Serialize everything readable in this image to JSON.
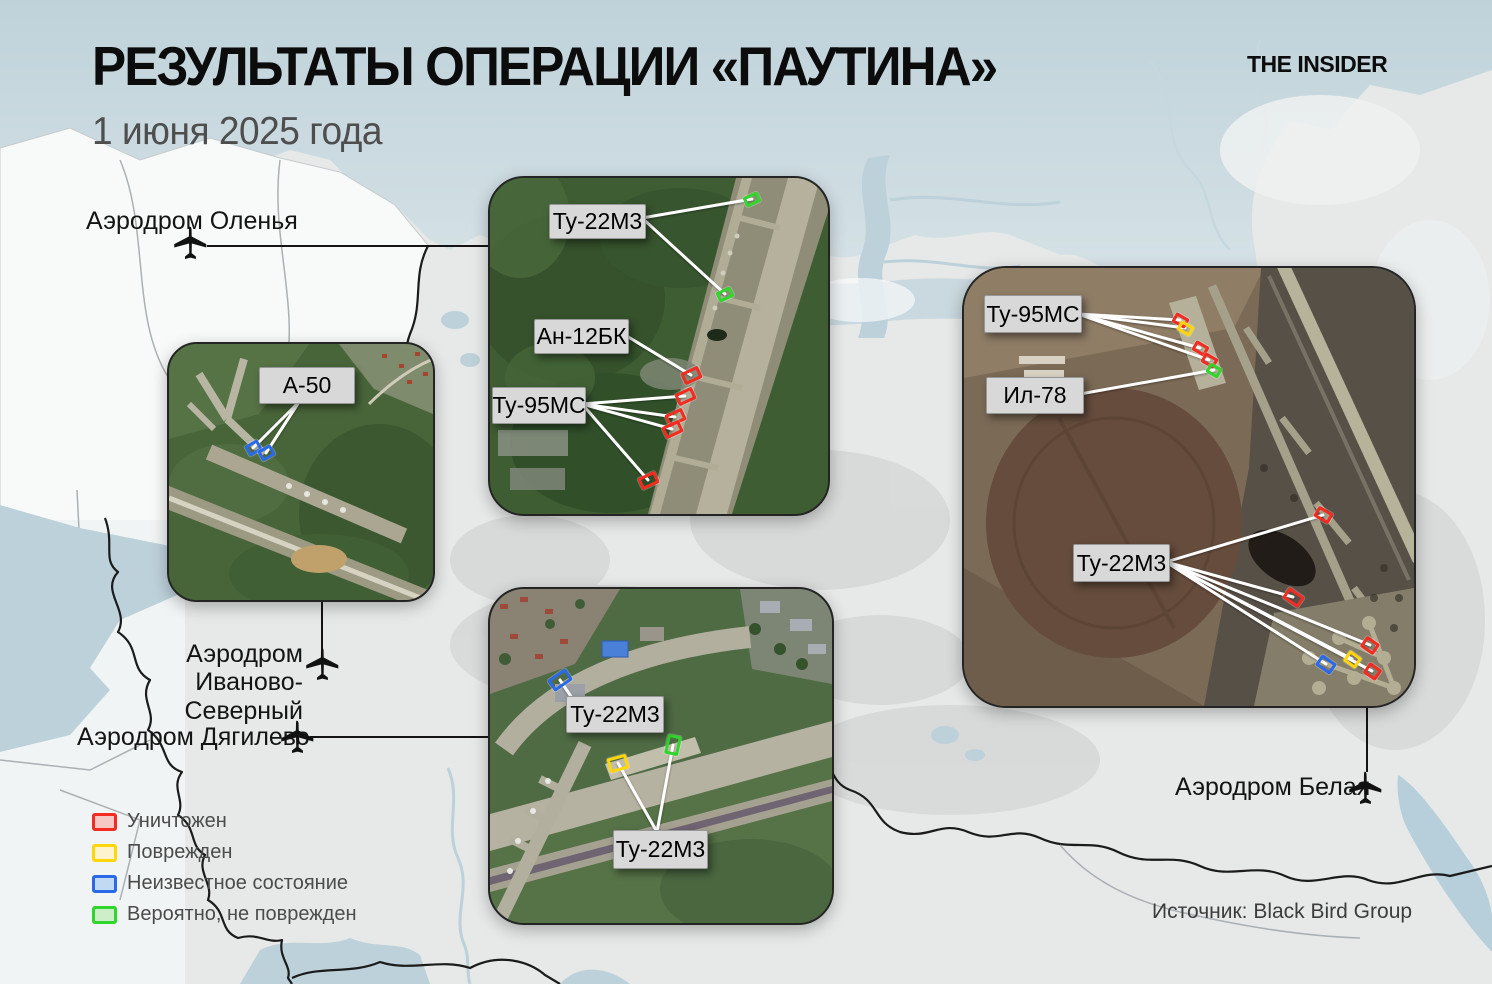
{
  "header": {
    "title": "РЕЗУЛЬТАТЫ ОПЕРАЦИИ «ПАУТИНА»",
    "subtitle": "1 июня 2025 года",
    "logo": "THE INSIDER"
  },
  "source_note": "Источник: Black Bird Group",
  "status_colors": {
    "destroyed": {
      "border": "#f32b20",
      "fill": "#f6c9c6"
    },
    "damaged": {
      "border": "#ffd60a",
      "fill": "#fdf3cc"
    },
    "unknown": {
      "border": "#2a6ae8",
      "fill": "#c2d9f4"
    },
    "undamaged": {
      "border": "#2fd62b",
      "fill": "#cdeec9"
    }
  },
  "legend": {
    "items": [
      {
        "label": "Уничтожен",
        "status": "destroyed"
      },
      {
        "label": "Поврежден",
        "status": "damaged"
      },
      {
        "label": "Неизвестное состояние",
        "status": "unknown"
      },
      {
        "label": "Вероятно, не поврежден",
        "status": "undamaged"
      }
    ]
  },
  "airfields": [
    {
      "name": "Аэродром Оленья"
    },
    {
      "name": "Аэродром Иваново-Северный"
    },
    {
      "name": "Аэродром Дягилево"
    },
    {
      "name": "Аэродром Белая"
    }
  ],
  "insets": {
    "olenya": {
      "callouts": [
        {
          "text": "Ту-22М3",
          "box": {
            "x": 59,
            "y": 26,
            "w": 95,
            "h": 33
          },
          "anchor": {
            "x": 152,
            "y": 40
          },
          "targets": [
            0,
            1
          ]
        },
        {
          "text": "Ан-12БК",
          "box": {
            "x": 44,
            "y": 141,
            "w": 93,
            "h": 33
          },
          "anchor": {
            "x": 135,
            "y": 157
          },
          "targets": [
            2
          ]
        },
        {
          "text": "Ту-95МС",
          "box": {
            "x": 2,
            "y": 209,
            "w": 92,
            "h": 35
          },
          "anchor": {
            "x": 92,
            "y": 226
          },
          "targets": [
            3,
            4,
            5,
            6
          ]
        }
      ],
      "markers": [
        {
          "x": 262,
          "y": 21,
          "w": 16,
          "h": 11,
          "rot": -25,
          "status": "undamaged"
        },
        {
          "x": 235,
          "y": 116,
          "w": 16,
          "h": 11,
          "rot": -25,
          "status": "undamaged"
        },
        {
          "x": 201,
          "y": 197,
          "w": 19,
          "h": 13,
          "rot": -25,
          "status": "destroyed"
        },
        {
          "x": 195,
          "y": 218,
          "w": 19,
          "h": 13,
          "rot": -25,
          "status": "destroyed"
        },
        {
          "x": 185,
          "y": 239,
          "w": 19,
          "h": 13,
          "rot": -25,
          "status": "destroyed"
        },
        {
          "x": 182,
          "y": 251,
          "w": 19,
          "h": 13,
          "rot": -25,
          "status": "destroyed"
        },
        {
          "x": 158,
          "y": 302,
          "w": 19,
          "h": 13,
          "rot": -25,
          "status": "destroyed"
        }
      ]
    },
    "ivanovo": {
      "callouts": [
        {
          "text": "А-50",
          "box": {
            "x": 90,
            "y": 23,
            "w": 94,
            "h": 35
          },
          "anchor": {
            "x": 130,
            "y": 58
          },
          "targets": [
            0,
            1
          ]
        }
      ],
      "markers": [
        {
          "x": 84,
          "y": 104,
          "w": 15,
          "h": 12,
          "rot": -30,
          "status": "unknown"
        },
        {
          "x": 97,
          "y": 109,
          "w": 15,
          "h": 12,
          "rot": -30,
          "status": "unknown"
        }
      ]
    },
    "dyagilevo": {
      "callouts": [
        {
          "text": "Ту-22М3",
          "box": {
            "x": 76,
            "y": 107,
            "w": 96,
            "h": 35
          },
          "anchor": {
            "x": 84,
            "y": 112
          },
          "targets": [
            0
          ]
        },
        {
          "text": "Ту-22М3",
          "box": {
            "x": 123,
            "y": 241,
            "w": 93,
            "h": 37
          },
          "anchor": {
            "x": 167,
            "y": 243
          },
          "targets": [
            1,
            2
          ]
        }
      ],
      "markers": [
        {
          "x": 70,
          "y": 91,
          "w": 22,
          "h": 14,
          "rot": -35,
          "status": "unknown"
        },
        {
          "x": 128,
          "y": 174,
          "w": 20,
          "h": 15,
          "rot": -15,
          "status": "damaged"
        },
        {
          "x": 183,
          "y": 156,
          "w": 14,
          "h": 20,
          "rot": 12,
          "status": "undamaged"
        }
      ]
    },
    "belaya": {
      "callouts": [
        {
          "text": "Ту-95МС",
          "box": {
            "x": 20,
            "y": 27,
            "w": 96,
            "h": 36
          },
          "anchor": {
            "x": 114,
            "y": 46
          },
          "targets": [
            0,
            1,
            2,
            3
          ]
        },
        {
          "text": "Ил-78",
          "box": {
            "x": 22,
            "y": 109,
            "w": 96,
            "h": 35
          },
          "anchor": {
            "x": 116,
            "y": 126
          },
          "targets": [
            4
          ]
        },
        {
          "text": "Ту-22М3",
          "box": {
            "x": 109,
            "y": 276,
            "w": 95,
            "h": 36
          },
          "anchor": {
            "x": 202,
            "y": 294
          },
          "targets": [
            5,
            6,
            7,
            8,
            9,
            10
          ]
        }
      ],
      "markers": [
        {
          "x": 216,
          "y": 52,
          "w": 15,
          "h": 11,
          "rot": 30,
          "status": "destroyed"
        },
        {
          "x": 221,
          "y": 60,
          "w": 15,
          "h": 11,
          "rot": 30,
          "status": "damaged"
        },
        {
          "x": 236,
          "y": 80,
          "w": 15,
          "h": 11,
          "rot": 30,
          "status": "destroyed"
        },
        {
          "x": 245,
          "y": 92,
          "w": 15,
          "h": 11,
          "rot": 30,
          "status": "destroyed"
        },
        {
          "x": 250,
          "y": 102,
          "w": 14,
          "h": 11,
          "rot": 30,
          "status": "undamaged"
        },
        {
          "x": 359,
          "y": 247,
          "w": 17,
          "h": 12,
          "rot": 30,
          "status": "destroyed"
        },
        {
          "x": 329,
          "y": 329,
          "w": 19,
          "h": 13,
          "rot": 35,
          "status": "destroyed"
        },
        {
          "x": 406,
          "y": 377,
          "w": 16,
          "h": 13,
          "rot": 35,
          "status": "destroyed"
        },
        {
          "x": 388,
          "y": 391,
          "w": 15,
          "h": 13,
          "rot": 35,
          "status": "damaged"
        },
        {
          "x": 362,
          "y": 396,
          "w": 18,
          "h": 13,
          "rot": 35,
          "status": "unknown"
        },
        {
          "x": 408,
          "y": 403,
          "w": 15,
          "h": 13,
          "rot": 35,
          "status": "destroyed"
        }
      ]
    }
  }
}
